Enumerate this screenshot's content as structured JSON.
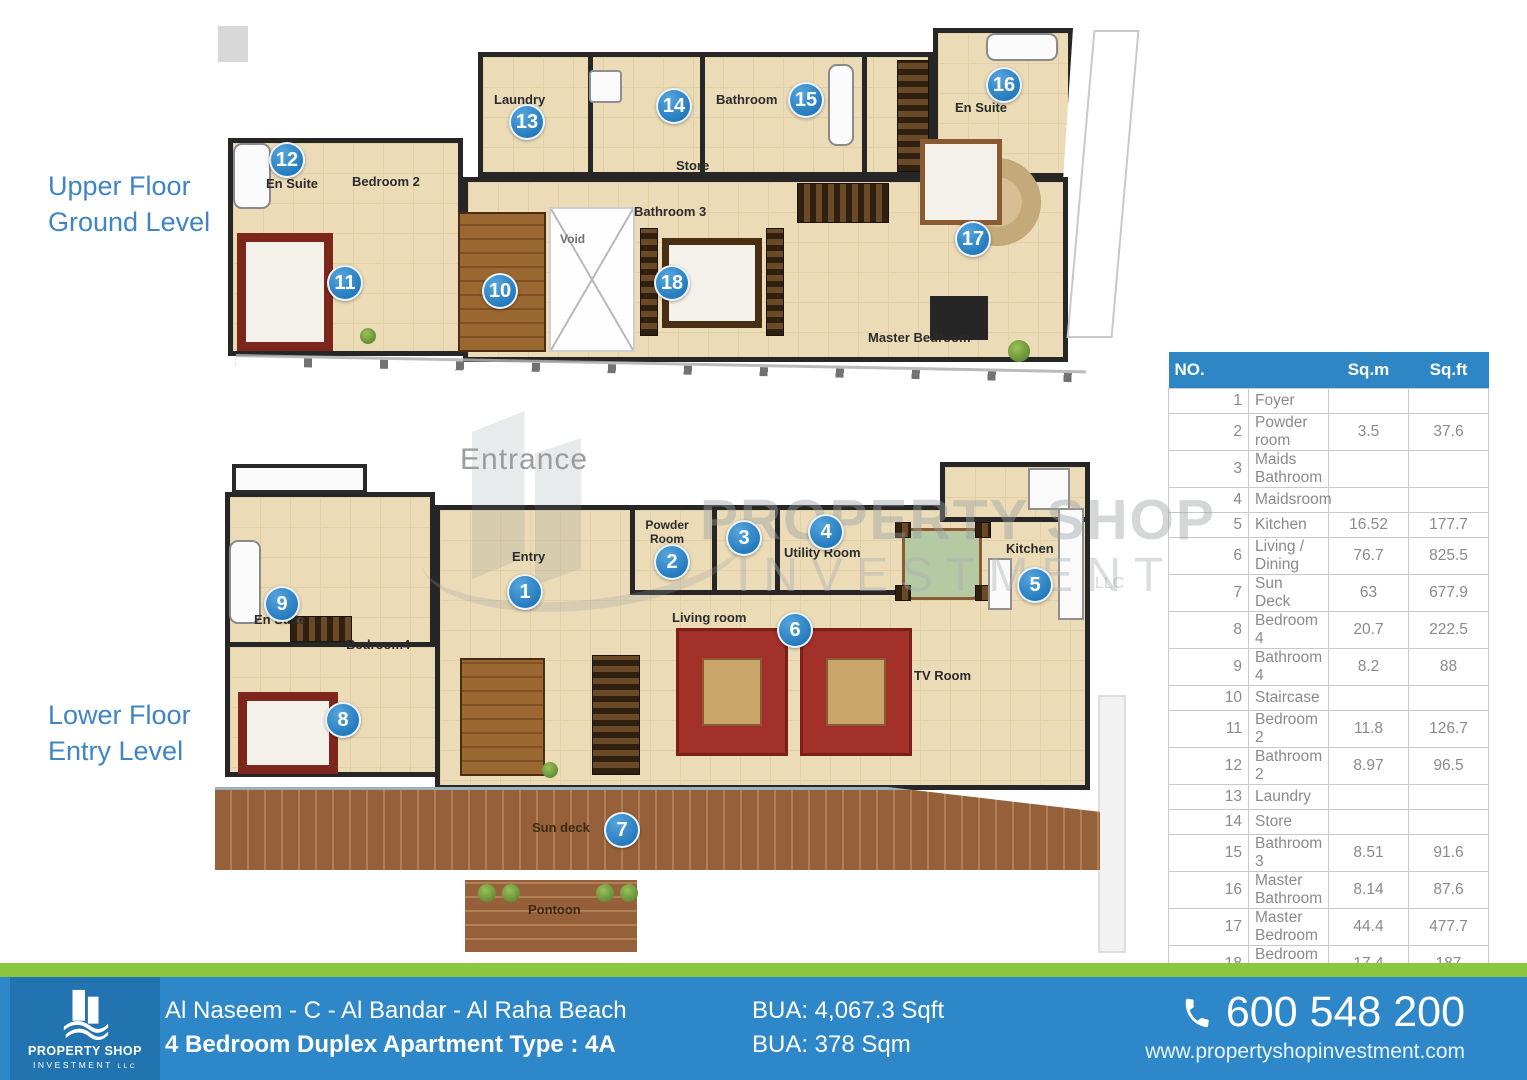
{
  "floor_sections": {
    "upper": {
      "line1": "Upper Floor",
      "line2": "Ground Level"
    },
    "lower": {
      "line1": "Lower Floor",
      "line2": "Entry Level"
    }
  },
  "upper_plan": {
    "labels": [
      {
        "t": "En Suite",
        "x": 266,
        "y": 176
      },
      {
        "t": "Bedroom 2",
        "x": 352,
        "y": 174
      },
      {
        "t": "Laundry",
        "x": 494,
        "y": 92
      },
      {
        "t": "Bathroom",
        "x": 716,
        "y": 92
      },
      {
        "t": "Store",
        "x": 676,
        "y": 158
      },
      {
        "t": "Bathroom 3",
        "x": 634,
        "y": 204
      },
      {
        "t": "Void",
        "x": 560,
        "y": 232,
        "c": "#6f6f6f",
        "s": 12
      },
      {
        "t": "En Suite",
        "x": 955,
        "y": 100
      },
      {
        "t": "Master Bedroom",
        "x": 868,
        "y": 330
      }
    ],
    "markers": [
      {
        "n": "10",
        "x": 500,
        "y": 291
      },
      {
        "n": "11",
        "x": 345,
        "y": 283
      },
      {
        "n": "12",
        "x": 287,
        "y": 160
      },
      {
        "n": "13",
        "x": 527,
        "y": 122
      },
      {
        "n": "14",
        "x": 674,
        "y": 106
      },
      {
        "n": "15",
        "x": 806,
        "y": 100
      },
      {
        "n": "16",
        "x": 1004,
        "y": 85
      },
      {
        "n": "17",
        "x": 973,
        "y": 239
      },
      {
        "n": "18",
        "x": 672,
        "y": 283
      }
    ]
  },
  "lower_plan": {
    "entrance": "Entrance",
    "labels": [
      {
        "t": "Entry",
        "x": 512,
        "y": 549
      },
      {
        "t": "Powder Room",
        "x": 630,
        "y": 519,
        "w": 74,
        "s": 12
      },
      {
        "t": "Utility Room",
        "x": 784,
        "y": 545
      },
      {
        "t": "Kitchen",
        "x": 1006,
        "y": 541
      },
      {
        "t": "Living room",
        "x": 672,
        "y": 610
      },
      {
        "t": "TV Room",
        "x": 914,
        "y": 668
      },
      {
        "t": "En Suite",
        "x": 254,
        "y": 612
      },
      {
        "t": "Bedroom4",
        "x": 346,
        "y": 637
      },
      {
        "t": "Sun deck",
        "x": 532,
        "y": 820,
        "c": "#3a2a14"
      },
      {
        "t": "Pontoon",
        "x": 528,
        "y": 902,
        "c": "#3a2a14"
      }
    ],
    "markers": [
      {
        "n": "1",
        "x": 525,
        "y": 592
      },
      {
        "n": "2",
        "x": 672,
        "y": 562
      },
      {
        "n": "3",
        "x": 744,
        "y": 538
      },
      {
        "n": "4",
        "x": 826,
        "y": 532
      },
      {
        "n": "5",
        "x": 1035,
        "y": 585
      },
      {
        "n": "6",
        "x": 795,
        "y": 630
      },
      {
        "n": "7",
        "x": 622,
        "y": 830
      },
      {
        "n": "8",
        "x": 343,
        "y": 720
      },
      {
        "n": "9",
        "x": 282,
        "y": 604
      }
    ]
  },
  "watermark": {
    "line1": "PROPERTY SHOP",
    "line2": "INVESTMENT",
    "llc": "LLC"
  },
  "table": {
    "h_no": "NO.",
    "h_sqm": "Sq.m",
    "h_sqft": "Sq.ft",
    "rows": [
      [
        "1",
        "Foyer",
        "",
        ""
      ],
      [
        "2",
        "Powder room",
        "3.5",
        "37.6"
      ],
      [
        "3",
        "Maids Bathroom",
        "",
        ""
      ],
      [
        "4",
        "Maidsroom",
        "",
        ""
      ],
      [
        "5",
        "Kitchen",
        "16.52",
        "177.7"
      ],
      [
        "6",
        "Living / Dining",
        "76.7",
        "825.5"
      ],
      [
        "7",
        "Sun Deck",
        "63",
        "677.9"
      ],
      [
        "8",
        "Bedroom 4",
        "20.7",
        "222.5"
      ],
      [
        "9",
        "Bathroom 4",
        "8.2",
        "88"
      ],
      [
        "10",
        "Staircase",
        "",
        ""
      ],
      [
        "11",
        "Bedroom 2",
        "11.8",
        "126.7"
      ],
      [
        "12",
        "Bathroom 2",
        "8.97",
        "96.5"
      ],
      [
        "13",
        "Laundry",
        "",
        ""
      ],
      [
        "14",
        "Store",
        "",
        ""
      ],
      [
        "15",
        "Bathroom 3",
        "8.51",
        "91.6"
      ],
      [
        "16",
        "Master Bathroom",
        "8.14",
        "87.6"
      ],
      [
        "17",
        "Master Bedroom",
        "44.4",
        "477.7"
      ],
      [
        "18",
        "Bedroom 3",
        "17.4",
        "187"
      ]
    ]
  },
  "footer": {
    "logo_line1": "PROPERTY SHOP",
    "logo_line2": "INVESTMENT",
    "logo_llc": "LLC",
    "title_line1": "Al Naseem - C - Al Bandar - Al Raha Beach",
    "title_line2": "4 Bedroom Duplex Apartment Type : 4A",
    "bua_line1": "BUA: 4,067.3 Sqft",
    "bua_line2": "BUA: 378 Sqm",
    "phone": "600 548 200",
    "website": "www.propertyshopinvestment.com"
  },
  "colors": {
    "accent_blue": "#2e87c9",
    "table_header_blue": "#2e86c4",
    "green": "#8cc63f",
    "label_blue": "#3f85c6",
    "floor_beige": "#ebdbb7",
    "wall": "#262626",
    "marker_blue": "#2379bc"
  }
}
